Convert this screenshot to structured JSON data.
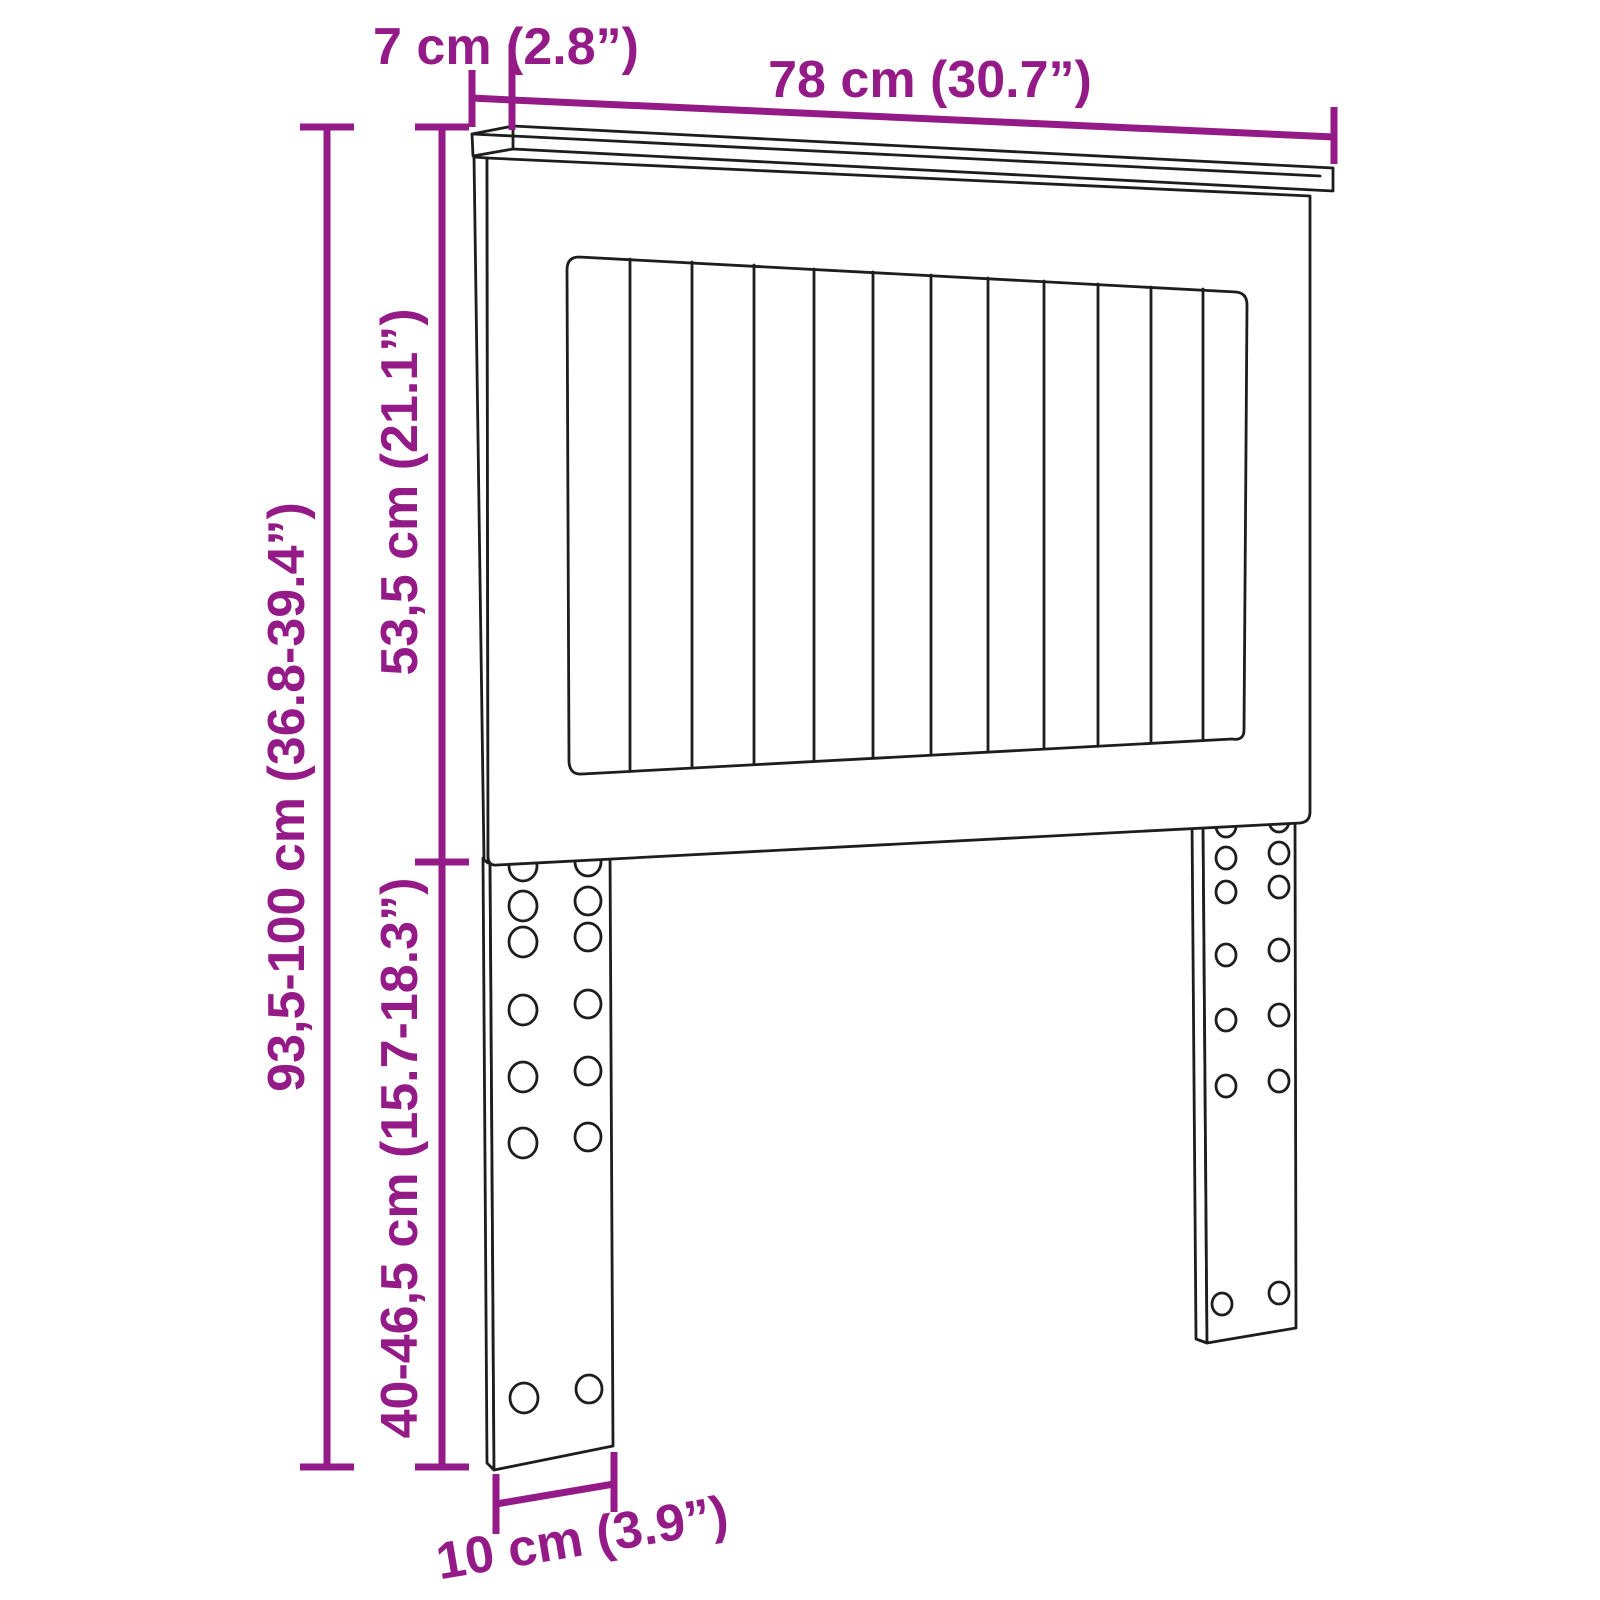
{
  "diagram": {
    "subject": "headboard-dimension-diagram",
    "colors": {
      "dimension_accent": "#941b87",
      "outline": "#1d1d1d",
      "background": "#ffffff"
    }
  },
  "dimensions": {
    "top_depth": {
      "label": "7 cm (2.8”)"
    },
    "top_width": {
      "label": "78 cm (30.7”)"
    },
    "total_height": {
      "label": "93,5-100 cm (36.8-39.4”)"
    },
    "headboard_height": {
      "label": "53,5 cm (21.1”)"
    },
    "leg_height": {
      "label": "40-46,5 cm (15.7-18.3”)"
    },
    "leg_width": {
      "label": "10 cm (3.9”)"
    }
  }
}
